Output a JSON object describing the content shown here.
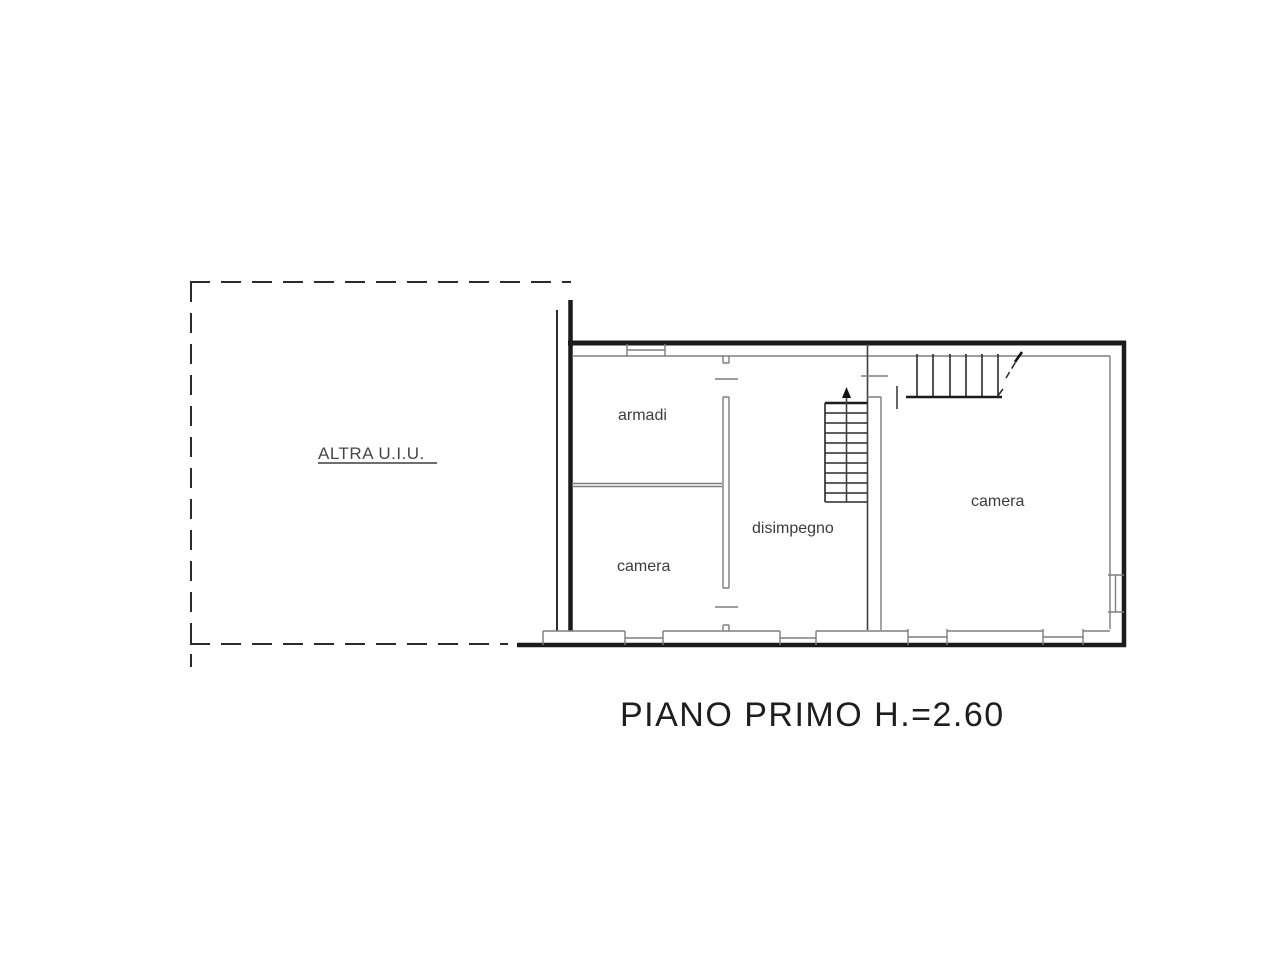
{
  "plan": {
    "title": "PIANO PRIMO H.=2.60",
    "other_unit_label": "ALTRA U.I.U.",
    "rooms": [
      {
        "name": "armadi",
        "label": "armadi"
      },
      {
        "name": "camera-left",
        "label": "camera"
      },
      {
        "name": "disimpegno",
        "label": "disimpegno"
      },
      {
        "name": "camera-right",
        "label": "camera"
      }
    ]
  },
  "colors": {
    "background": "#ffffff",
    "wall_line": "#1b1b1b",
    "thin_line": "#7e7e7e",
    "dashed_line": "#2b2b2b",
    "label_text": "#3c3c3c",
    "title_text": "#1e1e1e"
  }
}
